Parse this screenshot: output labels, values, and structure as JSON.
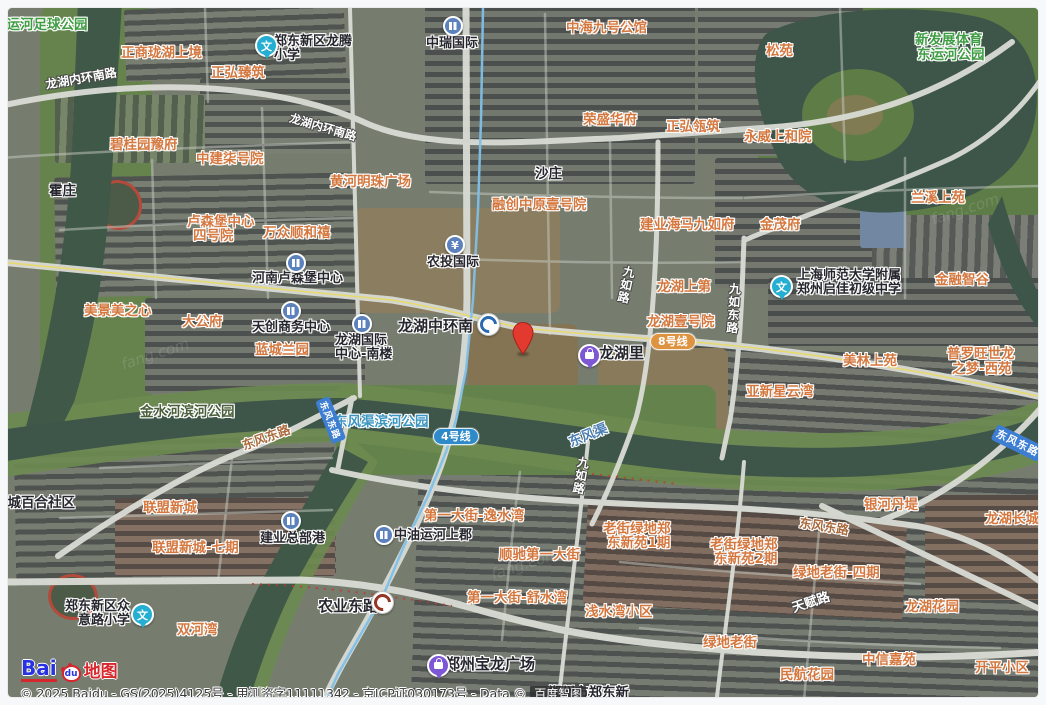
{
  "map": {
    "type": "satellite",
    "provider": "Baidu"
  },
  "attribution": {
    "text": "© 2025 Baidu - GS(2025)4125号 - 甲测资字11111342 - 京ICP证030173号 - Data © ",
    "brand_badge": "百度智图"
  },
  "logo": {
    "bai": "Bai",
    "du": "du",
    "suffix": "地图"
  },
  "marker": {
    "x": 523,
    "y": 354,
    "color": "#e23a2e",
    "stroke": "#a81f18"
  },
  "colors": {
    "residential_label": "#d4783f",
    "park_label": "#3f9d43",
    "water_label": "#4c80b4",
    "line4": "#2f8ac9",
    "line8": "#dd9340",
    "road_badge": "#3d7ed2",
    "metro_line": "#7fc0e8"
  },
  "transit_badges": [
    {
      "t": "4号线",
      "x": 433,
      "y": 428,
      "bg": "#2f8ac9"
    },
    {
      "t": "8号线",
      "x": 650,
      "y": 333,
      "bg": "#dd9340"
    }
  ],
  "metro_line4": {
    "name": "地铁4号线",
    "points": [
      [
        483,
        8
      ],
      [
        481,
        120
      ],
      [
        478,
        210
      ],
      [
        473,
        300
      ],
      [
        466,
        370
      ],
      [
        456,
        420
      ],
      [
        446,
        452
      ],
      [
        428,
        496
      ],
      [
        404,
        546
      ],
      [
        383,
        596
      ],
      [
        362,
        632
      ],
      [
        338,
        674
      ],
      [
        324,
        705
      ]
    ]
  },
  "labels": [
    {
      "t": "西运河足球公园",
      "x": -7,
      "y": 13,
      "c": "park"
    },
    {
      "t": "新发展体育",
      "x": 915,
      "y": 28,
      "c": "park"
    },
    {
      "t": "东运河公园",
      "x": 917,
      "y": 43,
      "c": "park"
    },
    {
      "t": "东风渠滨河公园",
      "x": 334,
      "y": 410,
      "c": "parkblue"
    },
    {
      "t": "金水河滨河公园",
      "x": 140,
      "y": 400,
      "c": "parkdark"
    },
    {
      "t": "东风渠",
      "x": 565,
      "y": 432,
      "c": "water",
      "r": -22
    },
    {
      "t": "霍庄",
      "x": 49,
      "y": 179,
      "c": "place"
    },
    {
      "t": "沙庄",
      "x": 535,
      "y": 162,
      "c": "place"
    },
    {
      "t": "绿城百合社区",
      "x": -6,
      "y": 491,
      "c": "place"
    },
    {
      "t": "郑州市郑东新",
      "x": 548,
      "y": 681,
      "c": "place"
    },
    {
      "t": "正商珑湖上境",
      "x": 121,
      "y": 41,
      "c": "res"
    },
    {
      "t": "正弘臻筑",
      "x": 211,
      "y": 61,
      "c": "res"
    },
    {
      "t": "中海九号公馆",
      "x": 566,
      "y": 16,
      "c": "res"
    },
    {
      "t": "松苑",
      "x": 766,
      "y": 39,
      "c": "res"
    },
    {
      "t": "正弘瓴筑",
      "x": 666,
      "y": 115,
      "c": "res"
    },
    {
      "t": "荣盛华府",
      "x": 583,
      "y": 108,
      "c": "res"
    },
    {
      "t": "永威上和院",
      "x": 744,
      "y": 125,
      "c": "res"
    },
    {
      "t": "碧桂园豫府",
      "x": 110,
      "y": 133,
      "c": "res"
    },
    {
      "t": "中建柒号院",
      "x": 196,
      "y": 147,
      "c": "res"
    },
    {
      "t": "黄河明珠广场",
      "x": 330,
      "y": 170,
      "c": "res"
    },
    {
      "t": "融创中原壹号院",
      "x": 492,
      "y": 193,
      "c": "res"
    },
    {
      "t": "建业海马九如府",
      "x": 640,
      "y": 213,
      "c": "res"
    },
    {
      "t": "金茂府",
      "x": 760,
      "y": 213,
      "c": "res"
    },
    {
      "t": "兰溪上苑",
      "x": 911,
      "y": 186,
      "c": "res"
    },
    {
      "t": "金融智谷",
      "x": 935,
      "y": 268,
      "c": "res"
    },
    {
      "t": "卢森堡中心",
      "x": 187,
      "y": 210,
      "c": "res"
    },
    {
      "t": "四号院",
      "x": 193,
      "y": 224,
      "c": "res"
    },
    {
      "t": "万众顺和禧",
      "x": 263,
      "y": 221,
      "c": "res"
    },
    {
      "t": "美景美之心",
      "x": 84,
      "y": 299,
      "c": "res"
    },
    {
      "t": "大公府",
      "x": 182,
      "y": 310,
      "c": "res"
    },
    {
      "t": "蓝城兰园",
      "x": 255,
      "y": 338,
      "c": "res"
    },
    {
      "t": "龙湖上第",
      "x": 657,
      "y": 275,
      "c": "res"
    },
    {
      "t": "龙湖壹号院",
      "x": 647,
      "y": 310,
      "c": "res"
    },
    {
      "t": "亚新星云湾",
      "x": 746,
      "y": 380,
      "c": "res"
    },
    {
      "t": "美林上苑",
      "x": 843,
      "y": 349,
      "c": "res"
    },
    {
      "t": "普罗旺世龙",
      "x": 947,
      "y": 342,
      "c": "res"
    },
    {
      "t": "之梦-西苑",
      "x": 952,
      "y": 357,
      "c": "res"
    },
    {
      "t": "联盟新城",
      "x": 143,
      "y": 496,
      "c": "res"
    },
    {
      "t": "联盟新城-七期",
      "x": 152,
      "y": 536,
      "c": "res"
    },
    {
      "t": "双河湾",
      "x": 177,
      "y": 618,
      "c": "res"
    },
    {
      "t": "第一大街-逸水湾",
      "x": 424,
      "y": 504,
      "c": "res"
    },
    {
      "t": "顺驰第一大街",
      "x": 499,
      "y": 543,
      "c": "res"
    },
    {
      "t": "第一大街-舒水湾",
      "x": 467,
      "y": 586,
      "c": "res"
    },
    {
      "t": "浅水湾小区",
      "x": 585,
      "y": 600,
      "c": "res"
    },
    {
      "t": "老街绿地郑",
      "x": 603,
      "y": 517,
      "c": "res"
    },
    {
      "t": "东新苑1期",
      "x": 607,
      "y": 531,
      "c": "res"
    },
    {
      "t": "老街绿地郑",
      "x": 710,
      "y": 533,
      "c": "res"
    },
    {
      "t": "东新苑2期",
      "x": 714,
      "y": 547,
      "c": "res"
    },
    {
      "t": "绿地老街-四期",
      "x": 793,
      "y": 561,
      "c": "res"
    },
    {
      "t": "银河丹堤",
      "x": 864,
      "y": 493,
      "c": "res"
    },
    {
      "t": "龙湖长城",
      "x": 985,
      "y": 507,
      "c": "res"
    },
    {
      "t": "龙湖花园",
      "x": 905,
      "y": 595,
      "c": "res"
    },
    {
      "t": "绿地老街",
      "x": 703,
      "y": 631,
      "c": "res"
    },
    {
      "t": "民航花园",
      "x": 780,
      "y": 663,
      "c": "res"
    },
    {
      "t": "中信嘉苑",
      "x": 862,
      "y": 648,
      "c": "res"
    },
    {
      "t": "开平小区",
      "x": 975,
      "y": 656,
      "c": "res"
    },
    {
      "t": "龙湖内环南路",
      "x": 44,
      "y": 76,
      "c": "roadw",
      "r": -10
    },
    {
      "t": "龙湖内环南路",
      "x": 292,
      "y": 110,
      "c": "roadw",
      "r": 16,
      "sz": 11.5
    },
    {
      "t": "九如路",
      "x": 622,
      "y": 264,
      "c": "roadw vert",
      "r": 12
    },
    {
      "t": "九如东路",
      "x": 727,
      "y": 282,
      "c": "roadw vert",
      "r": 4
    },
    {
      "t": "九如路",
      "x": 576,
      "y": 455,
      "c": "roadw vert",
      "r": 10
    },
    {
      "t": "东风东路",
      "x": 239,
      "y": 436,
      "c": "roadbr",
      "r": -20
    },
    {
      "t": "东风东路",
      "x": 801,
      "y": 512,
      "c": "roadbr",
      "r": 9
    },
    {
      "t": "天赋路",
      "x": 789,
      "y": 598,
      "c": "roadw",
      "r": -18,
      "sz": 13
    },
    {
      "t": "农业东路",
      "x": 318,
      "y": 595,
      "c": "place",
      "sz": 15
    },
    {
      "t": "龙湖中环南",
      "x": 398,
      "y": 315,
      "c": "place",
      "sz": 15
    },
    {
      "t": "东风东路",
      "x": 998,
      "y": 424,
      "c": "rbadge",
      "r": 26
    },
    {
      "t": "东风东路",
      "x": 329,
      "y": 396,
      "c": "rbadge",
      "r": 68,
      "sz": 9
    }
  ],
  "pois": [
    {
      "k": "school",
      "n": "郑东新区龙腾小学",
      "g": "文",
      "ix": 255,
      "iy": 34,
      "lx": 274,
      "ly": 35,
      "lines": [
        "郑东新区龙腾",
        "小学"
      ]
    },
    {
      "k": "school",
      "n": "上海师范大学附属郑州启佳初级中学",
      "g": "文",
      "ix": 770,
      "iy": 275,
      "lx": 797,
      "ly": 269,
      "lines": [
        "上海师范大学附属",
        "郑州启佳初级中学"
      ]
    },
    {
      "k": "school",
      "n": "郑东新区众意路小学",
      "g": "文",
      "ix": 131,
      "iy": 603,
      "lx": 40,
      "ly": 600,
      "w": 90,
      "align": "right",
      "lines": [
        "郑东新区众",
        "意路小学"
      ]
    },
    {
      "k": "building",
      "n": "中瑞国际",
      "ix": 443,
      "iy": 16,
      "lx": 426,
      "ly": 37,
      "lines": [
        "中瑞国际"
      ]
    },
    {
      "k": "building",
      "n": "河南卢森堡中心",
      "ix": 286,
      "iy": 253,
      "lx": 252,
      "ly": 272,
      "lines": [
        "河南卢森堡中心"
      ]
    },
    {
      "k": "building",
      "n": "天创商务中心",
      "ix": 281,
      "iy": 301,
      "lx": 252,
      "ly": 321,
      "lines": [
        "天创商务中心"
      ]
    },
    {
      "k": "building",
      "n": "龙湖国际中心-南楼",
      "ix": 352,
      "iy": 314,
      "lx": 335,
      "ly": 334,
      "lines": [
        "龙湖国际",
        "中心-南楼"
      ]
    },
    {
      "k": "bank",
      "n": "农投国际",
      "g": "¥",
      "ix": 445,
      "iy": 235,
      "lx": 427,
      "ly": 256,
      "lines": [
        "农投国际"
      ]
    },
    {
      "k": "building",
      "n": "建业总部港",
      "ix": 281,
      "iy": 511,
      "lx": 260,
      "ly": 532,
      "lines": [
        "建业总部港"
      ]
    },
    {
      "k": "building",
      "n": "中油运河上郡",
      "ix": 374,
      "iy": 525,
      "lx": 394,
      "ly": 529,
      "lines": [
        "中油运河上郡"
      ]
    },
    {
      "k": "shopping",
      "n": "龙湖里",
      "ix": 578,
      "iy": 344,
      "lx": 599,
      "ly": 346,
      "sz": 15,
      "lines": [
        "龙湖里"
      ]
    },
    {
      "k": "shopping",
      "n": "郑州宝龙广场",
      "ix": 427,
      "iy": 654,
      "lx": 445,
      "ly": 657,
      "sz": 15,
      "lines": [
        "郑州宝龙广场"
      ]
    },
    {
      "k": "metro",
      "n": "龙湖中环南站",
      "ix": 477,
      "iy": 313
    },
    {
      "k": "metro2",
      "n": "农业东路站",
      "ix": 371,
      "iy": 591
    }
  ],
  "watermark": {
    "text": "fang.com",
    "spots": [
      [
        930,
        200
      ],
      [
        490,
        555
      ],
      [
        120,
        345
      ]
    ]
  }
}
